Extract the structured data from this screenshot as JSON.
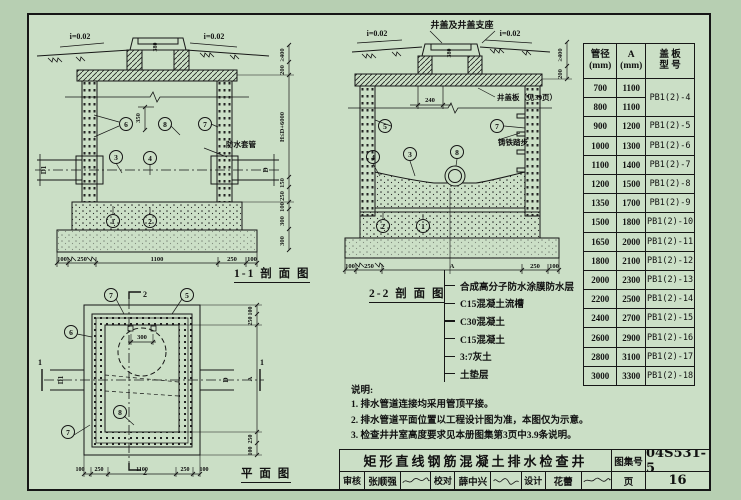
{
  "palette": {
    "paper": "#cbdfc6",
    "outer_bg": "#b7cfb2",
    "line": "#161616"
  },
  "callouts": {
    "1": "1",
    "2": "2",
    "3": "3",
    "4": "4",
    "5": "5",
    "6": "6",
    "7": "7",
    "8": "8"
  },
  "labels": {
    "slope": "i=0.02",
    "cover_support": "井盖及井盖支座",
    "cover_plate": "井盖板（见39页）",
    "steps": "铸铁踏步",
    "sleeve": "防水套管",
    "d1": "D1",
    "d": "D"
  },
  "marks": {
    "one": "1",
    "two": "2"
  },
  "captions": {
    "section11": "1-1 剖 面 图",
    "section22": "2-2 剖 面 图",
    "plan": "平 面 图"
  },
  "dims": {
    "s1_bottom": [
      "100",
      "250",
      "1100",
      "250",
      "100"
    ],
    "s1_right": [
      "≥400",
      "200",
      "150",
      "250",
      "100",
      "300",
      "300"
    ],
    "s1_height": "H≤D+6000",
    "s1_350": "350",
    "cover_380": "380",
    "s2_bottom": [
      "100",
      "250",
      "A",
      "250",
      "100"
    ],
    "s2_240": "240",
    "s2_right": [
      "≥400",
      "200"
    ],
    "plan_bottom": [
      "100",
      "250",
      "1100",
      "250",
      "100"
    ],
    "plan_right": [
      "100",
      "250",
      "A",
      "250",
      "100"
    ],
    "plan_300": "300"
  },
  "legend": {
    "items": [
      "合成高分子防水涂膜防水层",
      "C15混凝土流槽",
      "C30混凝土",
      "C15混凝土",
      "3:7灰土",
      "土垫层"
    ]
  },
  "notes": {
    "heading": "说明:",
    "items": [
      "1. 排水管道连接均采用管顶平接。",
      "2. 排水管道平面位置以工程设计图为准，本图仅为示意。",
      "3. 检查井井室高度要求见本册图集第3页中3.9条说明。"
    ]
  },
  "table": {
    "headers": [
      {
        "l1": "管径",
        "l2": "(mm)"
      },
      {
        "l1": "A",
        "l2": "(mm)"
      },
      {
        "l1": "盖 板",
        "l2": "型 号"
      }
    ],
    "rows": [
      {
        "dia": "700",
        "a": "1100",
        "model": "PB1(2)-4",
        "span": 2
      },
      {
        "dia": "800",
        "a": "1100"
      },
      {
        "dia": "900",
        "a": "1200",
        "model": "PB1(2)-5"
      },
      {
        "dia": "1000",
        "a": "1300",
        "model": "PB1(2)-6"
      },
      {
        "dia": "1100",
        "a": "1400",
        "model": "PB1(2)-7"
      },
      {
        "dia": "1200",
        "a": "1500",
        "model": "PB1(2)-8"
      },
      {
        "dia": "1350",
        "a": "1700",
        "model": "PB1(2)-9"
      },
      {
        "dia": "1500",
        "a": "1800",
        "model": "PB1(2)-10"
      },
      {
        "dia": "1650",
        "a": "2000",
        "model": "PB1(2)-11"
      },
      {
        "dia": "1800",
        "a": "2100",
        "model": "PB1(2)-12"
      },
      {
        "dia": "2000",
        "a": "2300",
        "model": "PB1(2)-13"
      },
      {
        "dia": "2200",
        "a": "2500",
        "model": "PB1(2)-14"
      },
      {
        "dia": "2400",
        "a": "2700",
        "model": "PB1(2)-15"
      },
      {
        "dia": "2600",
        "a": "2900",
        "model": "PB1(2)-16"
      },
      {
        "dia": "2800",
        "a": "3100",
        "model": "PB1(2)-17"
      },
      {
        "dia": "3000",
        "a": "3300",
        "model": "PB1(2)-18"
      }
    ]
  },
  "titleblock": {
    "title": "矩形直线钢筋混凝土排水检查井",
    "atlas_label": "图集号",
    "atlas_no": "04S531-5",
    "page_label": "页",
    "page_no": "16",
    "reviewer_label": "审核",
    "reviewer": "张顺强",
    "checker_label": "校对",
    "checker": "薛中兴",
    "designer_label": "设计",
    "designer": "花蕾"
  }
}
